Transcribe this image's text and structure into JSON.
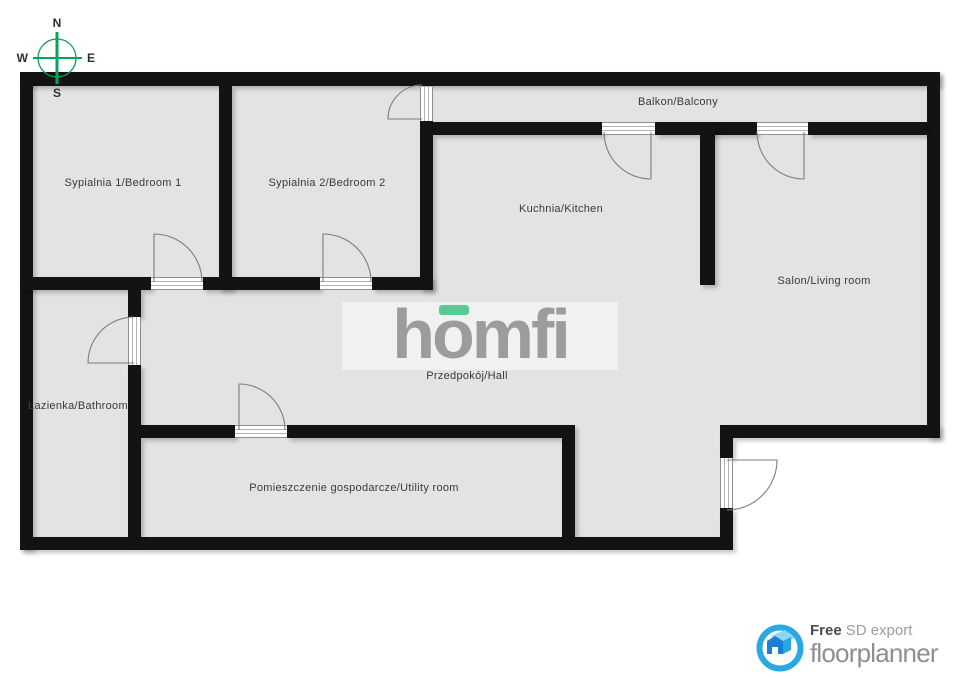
{
  "compass": {
    "north": "N",
    "east": "E",
    "south": "S",
    "west": "W"
  },
  "rooms": {
    "bedroom1": "Sypialnia 1/Bedroom 1",
    "bedroom2": "Sypialnia 2/Bedroom 2",
    "kitchen": "Kuchnia/Kitchen",
    "balcony": "Balkon/Balcony",
    "living": "Salon/Living room",
    "bathroom": "Łazienka/Bathroom",
    "hall": "Przedpokój/Hall",
    "utility": "Pomieszczenie gospodarcze/Utility room"
  },
  "watermark": {
    "part1": "h",
    "accent": "o",
    "part2": "mfi"
  },
  "footer": {
    "free": "Free",
    "sd": "SD export",
    "brand": "floorplanner"
  },
  "colors": {
    "wall": "#131313",
    "floor": "#e3e3e3",
    "compass_green": "#0aa159",
    "homfi_gray": "#9c9c9c",
    "homfi_green": "#5bc994",
    "floorplanner_blue": "#29a9e3"
  }
}
